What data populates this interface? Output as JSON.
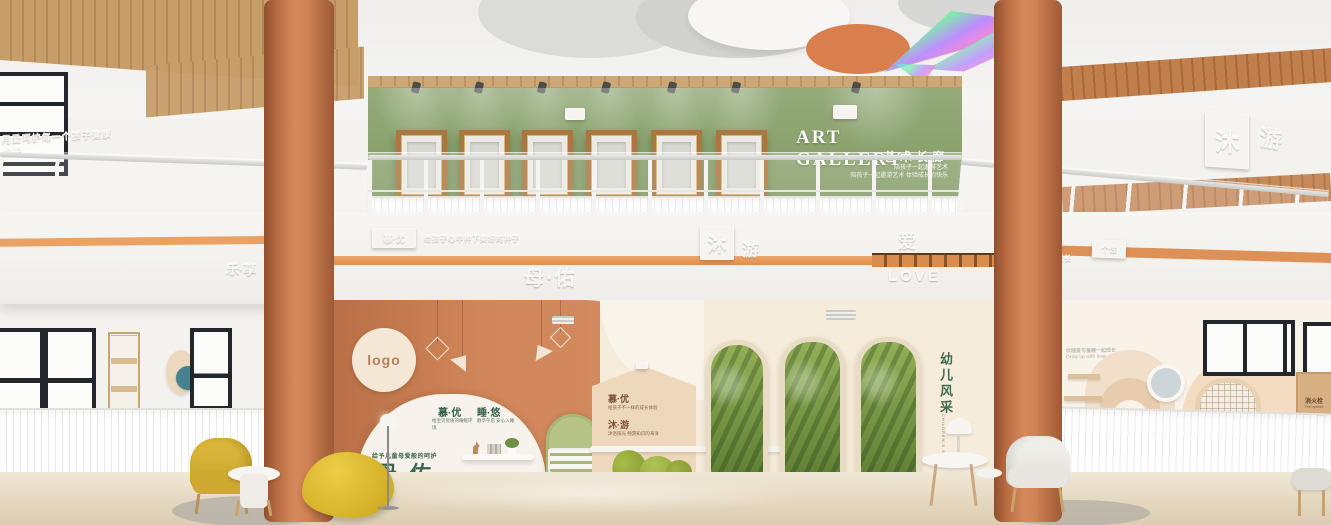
{
  "art_gallery": {
    "title": "ART GALLERY",
    "subtitle": "艺术长廊",
    "tagline_line1": "陪孩子一起遨游艺术",
    "tagline_line2": "陪孩子一起遨游艺术 体验成长的快乐"
  },
  "upper_left_wall": {
    "embossed_tagline": "用爱呵护每一个孩子健康成长"
  },
  "upper_right_wall": {
    "plaque_char1": "沐",
    "plaque_char2": "游"
  },
  "fascia": {
    "left_plaque": "慕·优",
    "left_tagline": "给孩子心中种下美好的种子",
    "left_chars": "乐·享",
    "center_plaque_char1": "沐",
    "center_plaque_char2": "游",
    "center_name": "母·佑",
    "love_char": "爱",
    "love_en": "LOVE",
    "right_chars": "美·育",
    "right_tagline": "让每个孩子快乐成长",
    "right_plaque": "个性"
  },
  "lobby": {
    "logo_text": "logo",
    "care_tagline": "给予儿童母爱般的呵护",
    "brand_name": "母·佑",
    "sleep_sign": {
      "h1": "慕·优",
      "h2": "睡·悠",
      "p1": "给宝贝优质的睡眠环境",
      "p2": "静享午后 安心入睡"
    },
    "house_sign": {
      "h1": "慕·优",
      "p1": "给孩子不一样的成长体验",
      "h2": "沐·游",
      "p2": "沐浴阳光 畅游知识的海洋"
    },
    "kids_corner": {
      "title_vertical": "幼儿风采",
      "subtitle_vertical": "CHILDREN'S STYLE"
    }
  },
  "right_wing": {
    "wall_tagline_line1": "伴随爱与童趣一起成长",
    "wall_tagline_line2": "Grow up with love",
    "fire_sign_title": "消火栓",
    "fire_sign_sub": "Fire hydrant"
  },
  "colors": {
    "terracotta": "#c97c4f",
    "sage_green": "#8aa06d",
    "accent_orange": "#e49a5f",
    "cream": "#f5ead8",
    "brand_green": "#34624a",
    "yellow": "#d7b43a"
  }
}
